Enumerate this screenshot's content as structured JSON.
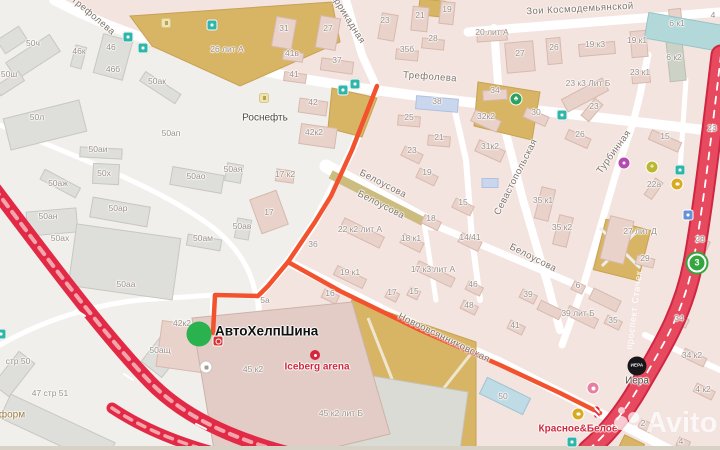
{
  "origin": {
    "label": "АвтоХелпШина"
  },
  "watermark": {
    "text": "Avito"
  },
  "street_labels": [
    {
      "text": "Трефолева",
      "x": 93,
      "y": 16,
      "rot": 40
    },
    {
      "text": "Трефолева",
      "x": 430,
      "y": 77,
      "rot": 4
    },
    {
      "text": "Зои Космодемьянской",
      "x": 580,
      "y": 9,
      "rot": -3
    },
    {
      "text": "Баррикадная",
      "x": 346,
      "y": 16,
      "rot": 58
    },
    {
      "text": "Белоусова",
      "x": 383,
      "y": 184,
      "rot": 27
    },
    {
      "text": "Белоусова",
      "x": 381,
      "y": 205,
      "rot": 27
    },
    {
      "text": "Белоусова",
      "x": 533,
      "y": 258,
      "rot": 27
    },
    {
      "text": "Севастопольская",
      "x": 516,
      "y": 177,
      "rot": -63
    },
    {
      "text": "Турбинная",
      "x": 614,
      "y": 152,
      "rot": -54
    },
    {
      "text": "Новоовсянниковская",
      "x": 444,
      "y": 338,
      "rot": 26
    },
    {
      "text": "проспект Стачек",
      "x": 634,
      "y": 310,
      "rot": -83,
      "cls": "on-red"
    }
  ],
  "building_labels": [
    {
      "text": "50ч",
      "x": 33,
      "y": 43
    },
    {
      "text": "46к",
      "x": 79,
      "y": 51
    },
    {
      "text": "46",
      "x": 111,
      "y": 47
    },
    {
      "text": "46б",
      "x": 113,
      "y": 69
    },
    {
      "text": "50ак",
      "x": 157,
      "y": 81
    },
    {
      "text": "50ш",
      "x": 9,
      "y": 74
    },
    {
      "text": "50л",
      "x": 37,
      "y": 117
    },
    {
      "text": "26 лит А",
      "x": 227,
      "y": 49
    },
    {
      "text": "50ап",
      "x": 171,
      "y": 133
    },
    {
      "text": "50аи",
      "x": 98,
      "y": 149
    },
    {
      "text": "50х",
      "x": 104,
      "y": 173
    },
    {
      "text": "50аж",
      "x": 58,
      "y": 183
    },
    {
      "text": "50ан",
      "x": 48,
      "y": 216
    },
    {
      "text": "50ах",
      "x": 60,
      "y": 238
    },
    {
      "text": "50ар",
      "x": 118,
      "y": 208
    },
    {
      "text": "50аа",
      "x": 126,
      "y": 284
    },
    {
      "text": "50ао",
      "x": 196,
      "y": 176
    },
    {
      "text": "50ая",
      "x": 233,
      "y": 169
    },
    {
      "text": "50ав",
      "x": 242,
      "y": 226
    },
    {
      "text": "50ам",
      "x": 203,
      "y": 238
    },
    {
      "text": "50ащ",
      "x": 160,
      "y": 350
    },
    {
      "text": "стр 50",
      "x": 18,
      "y": 361
    },
    {
      "text": "47 стр 51",
      "x": 50,
      "y": 393
    },
    {
      "text": "42к2",
      "x": 182,
      "y": 323
    },
    {
      "text": "5а",
      "x": 265,
      "y": 300
    },
    {
      "text": "31",
      "x": 284,
      "y": 28
    },
    {
      "text": "27",
      "x": 328,
      "y": 28
    },
    {
      "text": "23",
      "x": 385,
      "y": 20
    },
    {
      "text": "21",
      "x": 420,
      "y": 15
    },
    {
      "text": "19",
      "x": 447,
      "y": 9
    },
    {
      "text": "28",
      "x": 433,
      "y": 38
    },
    {
      "text": "35б",
      "x": 407,
      "y": 49
    },
    {
      "text": "37",
      "x": 337,
      "y": 60
    },
    {
      "text": "41в",
      "x": 292,
      "y": 53
    },
    {
      "text": "41",
      "x": 294,
      "y": 74
    },
    {
      "text": "42",
      "x": 313,
      "y": 102
    },
    {
      "text": "42к2",
      "x": 314,
      "y": 132
    },
    {
      "text": "38",
      "x": 437,
      "y": 101
    },
    {
      "text": "25",
      "x": 409,
      "y": 117
    },
    {
      "text": "21",
      "x": 439,
      "y": 137
    },
    {
      "text": "34",
      "x": 495,
      "y": 90
    },
    {
      "text": "30",
      "x": 536,
      "y": 112
    },
    {
      "text": "32к2",
      "x": 486,
      "y": 116
    },
    {
      "text": "31к2",
      "x": 490,
      "y": 146
    },
    {
      "text": "23",
      "x": 594,
      "y": 106
    },
    {
      "text": "26",
      "x": 580,
      "y": 134
    },
    {
      "text": "23 к3 Лит Б",
      "x": 588,
      "y": 83
    },
    {
      "text": "27",
      "x": 520,
      "y": 53
    },
    {
      "text": "26",
      "x": 554,
      "y": 47
    },
    {
      "text": "19 к3",
      "x": 595,
      "y": 44
    },
    {
      "text": "19 к1",
      "x": 637,
      "y": 40
    },
    {
      "text": "6 к1",
      "x": 677,
      "y": 23
    },
    {
      "text": "6 к2",
      "x": 674,
      "y": 57
    },
    {
      "text": "23 к1",
      "x": 640,
      "y": 72
    },
    {
      "text": "20 лит А",
      "x": 492,
      "y": 32
    },
    {
      "text": "4",
      "x": 713,
      "y": 15
    },
    {
      "text": "15",
      "x": 665,
      "y": 136
    },
    {
      "text": "23",
      "x": 712,
      "y": 128
    },
    {
      "text": "35 к1",
      "x": 543,
      "y": 200
    },
    {
      "text": "35 к2",
      "x": 562,
      "y": 227
    },
    {
      "text": "22а",
      "x": 654,
      "y": 184
    },
    {
      "text": "27 лит Д",
      "x": 640,
      "y": 231
    },
    {
      "text": "29",
      "x": 645,
      "y": 258
    },
    {
      "text": "28",
      "x": 700,
      "y": 239
    },
    {
      "text": "23",
      "x": 412,
      "y": 150
    },
    {
      "text": "19",
      "x": 427,
      "y": 172
    },
    {
      "text": "15",
      "x": 463,
      "y": 202
    },
    {
      "text": "18",
      "x": 431,
      "y": 218
    },
    {
      "text": "18 к1",
      "x": 411,
      "y": 238
    },
    {
      "text": "14/41",
      "x": 470,
      "y": 237
    },
    {
      "text": "22 к2 лит А",
      "x": 360,
      "y": 229
    },
    {
      "text": "36",
      "x": 313,
      "y": 244
    },
    {
      "text": "19 к1",
      "x": 350,
      "y": 272
    },
    {
      "text": "17 к3 лит А",
      "x": 433,
      "y": 269
    },
    {
      "text": "46",
      "x": 473,
      "y": 284
    },
    {
      "text": "16",
      "x": 330,
      "y": 293
    },
    {
      "text": "17",
      "x": 392,
      "y": 292
    },
    {
      "text": "15",
      "x": 414,
      "y": 291
    },
    {
      "text": "17 к2",
      "x": 285,
      "y": 174
    },
    {
      "text": "17",
      "x": 269,
      "y": 212
    },
    {
      "text": "45 к2",
      "x": 253,
      "y": 369
    },
    {
      "text": "45 к2 лит Б",
      "x": 341,
      "y": 413
    },
    {
      "text": "48",
      "x": 469,
      "y": 305
    },
    {
      "text": "39",
      "x": 528,
      "y": 294
    },
    {
      "text": "41",
      "x": 515,
      "y": 325
    },
    {
      "text": "6",
      "x": 578,
      "y": 285
    },
    {
      "text": "39 лит Б",
      "x": 578,
      "y": 313
    },
    {
      "text": "35",
      "x": 613,
      "y": 320
    },
    {
      "text": "50",
      "x": 503,
      "y": 396
    },
    {
      "text": "34",
      "x": 679,
      "y": 318
    },
    {
      "text": "34 к2",
      "x": 692,
      "y": 355
    },
    {
      "text": "4 к2",
      "x": 703,
      "y": 389
    },
    {
      "text": "2",
      "x": 643,
      "y": 423
    },
    {
      "text": "4",
      "x": 681,
      "y": 441
    }
  ],
  "poi_labels": [
    {
      "text": "Роснефть",
      "x": 265,
      "y": 118,
      "cls": "poi-dark"
    },
    {
      "text": "Iceberg arena",
      "x": 317,
      "y": 367,
      "cls": "poi-red"
    },
    {
      "text": "Красное&Белое",
      "x": 578,
      "y": 429,
      "cls": "poi-red"
    },
    {
      "text": "Иера",
      "x": 637,
      "y": 381,
      "cls": "poi-dark"
    },
    {
      "text": "форм",
      "x": 12,
      "y": 415,
      "cls": "poi-brown"
    }
  ],
  "icons": [
    {
      "name": "transit-stop-icon",
      "cls": "ic-transit",
      "x": 128,
      "y": 37
    },
    {
      "name": "transit-stop-icon",
      "cls": "ic-transit",
      "x": 143,
      "y": 48
    },
    {
      "name": "transit-stop-icon",
      "cls": "ic-transit",
      "x": 212,
      "y": 25
    },
    {
      "name": "transit-stop-icon",
      "cls": "ic-transit",
      "x": 343,
      "y": 90
    },
    {
      "name": "transit-stop-icon",
      "cls": "ic-transit",
      "x": 355,
      "y": 84
    },
    {
      "name": "transit-stop-icon",
      "cls": "ic-transit",
      "x": 562,
      "y": 115
    },
    {
      "name": "transit-stop-icon",
      "cls": "ic-transit",
      "x": 680,
      "y": 170
    },
    {
      "name": "transit-stop-icon",
      "cls": "ic-transit",
      "x": 572,
      "y": 442
    },
    {
      "name": "transit-stop-icon",
      "cls": "ic-transit",
      "x": 1,
      "y": 334
    },
    {
      "name": "transit-blue-icon",
      "cls": "ic-blue",
      "x": 688,
      "y": 215
    },
    {
      "name": "park-tree-icon",
      "cls": "ic-tree",
      "x": 516,
      "y": 99,
      "text": "♣"
    },
    {
      "name": "poi-purple-icon",
      "cls": "ic-purple",
      "x": 624,
      "y": 163
    },
    {
      "name": "pharmacy-cross-icon",
      "cls": "ic-cross",
      "x": 652,
      "y": 167,
      "text": "+"
    },
    {
      "name": "store-cart-icon",
      "cls": "ic-cart",
      "x": 677,
      "y": 184
    },
    {
      "name": "store-cart-icon",
      "cls": "ic-cart",
      "x": 578,
      "y": 414
    },
    {
      "name": "transit-route-badge",
      "cls": "ic-route3",
      "x": 697,
      "y": 263,
      "text": "3"
    },
    {
      "name": "poi-pink-icon",
      "cls": "ic-pink",
      "x": 593,
      "y": 388
    },
    {
      "name": "poi-white-icon",
      "cls": "ic-white",
      "x": 206,
      "y": 367
    },
    {
      "name": "fuel-station-icon",
      "cls": "ic-fuel",
      "x": 264,
      "y": 98
    },
    {
      "name": "fuel-station-icon",
      "cls": "ic-fuel",
      "x": 166,
      "y": 23
    },
    {
      "name": "iera-logo-badge",
      "cls": "ic-iera",
      "x": 637,
      "y": 366,
      "text": "ИЕРА"
    },
    {
      "name": "tire-shop-icon",
      "cls": "ic-tire",
      "x": 218,
      "y": 341
    },
    {
      "name": "iceberg-arena-icon",
      "cls": "ic-iceberg",
      "x": 315,
      "y": 355
    },
    {
      "name": "route-end-marker",
      "cls": "ic-end",
      "x": 597,
      "y": 412
    }
  ]
}
